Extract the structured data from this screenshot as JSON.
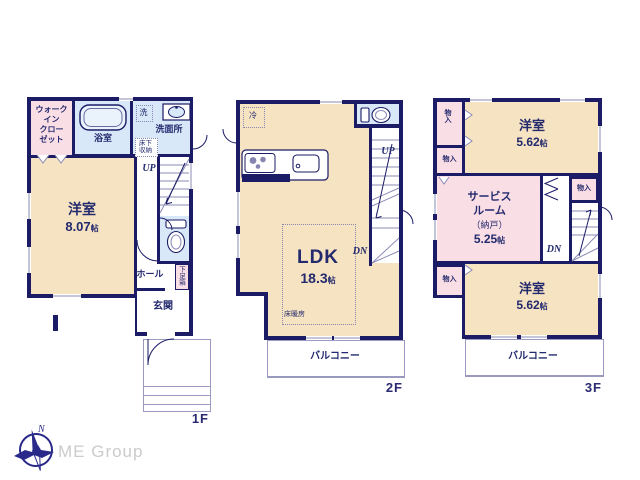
{
  "colors": {
    "wall": "#1b1b66",
    "room_cream": "#f6e3c1",
    "room_pink": "#fadee6",
    "room_blue": "#d9e8f8",
    "text_navy": "#232a6e",
    "line_light": "#8b8bb5",
    "logo_gray": "#cbcbcb"
  },
  "size_unit": "帖",
  "f1": {
    "label": "1F",
    "wic": "ウォーク\nイン\nクロー\nゼット",
    "bath": "浴室",
    "washer": "洗",
    "washroom": "洗面所",
    "floor_storage": "床下\n収納",
    "up": "UP",
    "bedroom_name": "洋室",
    "bedroom_size": "8.07",
    "hall": "ホール",
    "shoe_box": "下足箱",
    "entrance": "玄関"
  },
  "f2": {
    "label": "2F",
    "fridge": "冷",
    "up": "UP",
    "dn": "DN",
    "ldk_name": "LDK",
    "ldk_size": "18.3",
    "floor_heating": "床暖房",
    "balcony": "バルコニー"
  },
  "f3": {
    "label": "3F",
    "storage": "物入",
    "bedroom_top_name": "洋室",
    "bedroom_top_size": "5.62",
    "service_name": "サービス\nルーム",
    "service_sub": "（納戸）",
    "service_size": "5.25",
    "dn": "DN",
    "bedroom_bottom_name": "洋室",
    "bedroom_bottom_size": "5.62",
    "balcony": "バルコニー"
  },
  "footer": {
    "brand": "ME Group",
    "north": "N"
  }
}
